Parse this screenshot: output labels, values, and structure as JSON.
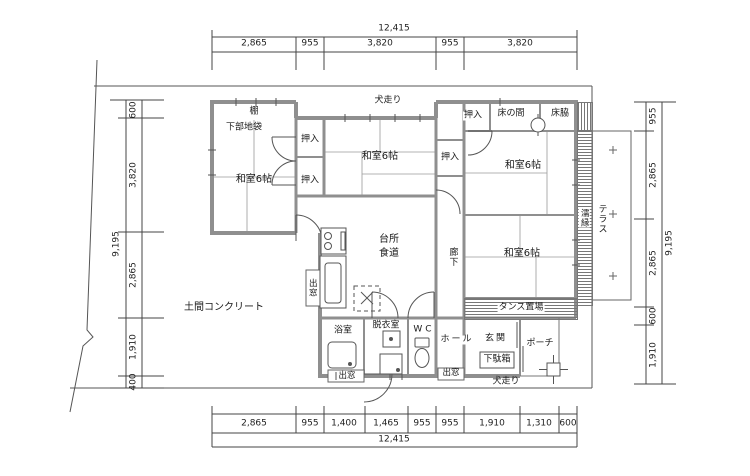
{
  "plan": {
    "dimensions": {
      "top": {
        "total": "12,415",
        "segments": [
          "2,865",
          "955",
          "3,820",
          "955",
          "3,820"
        ]
      },
      "bottom": {
        "total": "12,415",
        "segments": [
          "2,865",
          "955",
          "1,400",
          "1,465",
          "955",
          "955",
          "1,910",
          "1,310",
          "600"
        ]
      },
      "left": {
        "total": "9,195",
        "segments": [
          "600",
          "3,820",
          "2,865",
          "1,910",
          "400"
        ]
      },
      "right": {
        "total": "9,195",
        "segments": [
          "955",
          "2,865",
          "2,865",
          "600",
          "1,910"
        ]
      }
    },
    "labels": {
      "shelf": "棚",
      "under_cabinet": "下部地袋",
      "washitsu_nw": "和室6帖",
      "washitsu_n": "和室6帖",
      "washitsu_ne": "和室6帖",
      "washitsu_e": "和室6帖",
      "closet_nw": "押入",
      "closet_w": "押入",
      "closet_c": "押入",
      "closet_ne": "押入",
      "tokonoma": "床の間",
      "tokowaki": "床脇",
      "kitchen_1": "台所",
      "kitchen_2": "食道",
      "corridor": "廊下",
      "doma": "土間コンクリート",
      "tansu": "タンス置場",
      "nureen": "濡縁",
      "terrace": "テラス",
      "inubashiri_top": "犬走り",
      "inubashiri_bottom": "犬走り",
      "bay_kitchen": "出窓",
      "bay_bath": "出窓",
      "bay_hall": "出窓",
      "bath": "浴室",
      "dressing": "脱衣室",
      "wc": "WC",
      "hall": "ホール",
      "entrance": "玄関",
      "shoe_cabinet": "下駄箱",
      "porch": "ポーチ"
    }
  }
}
